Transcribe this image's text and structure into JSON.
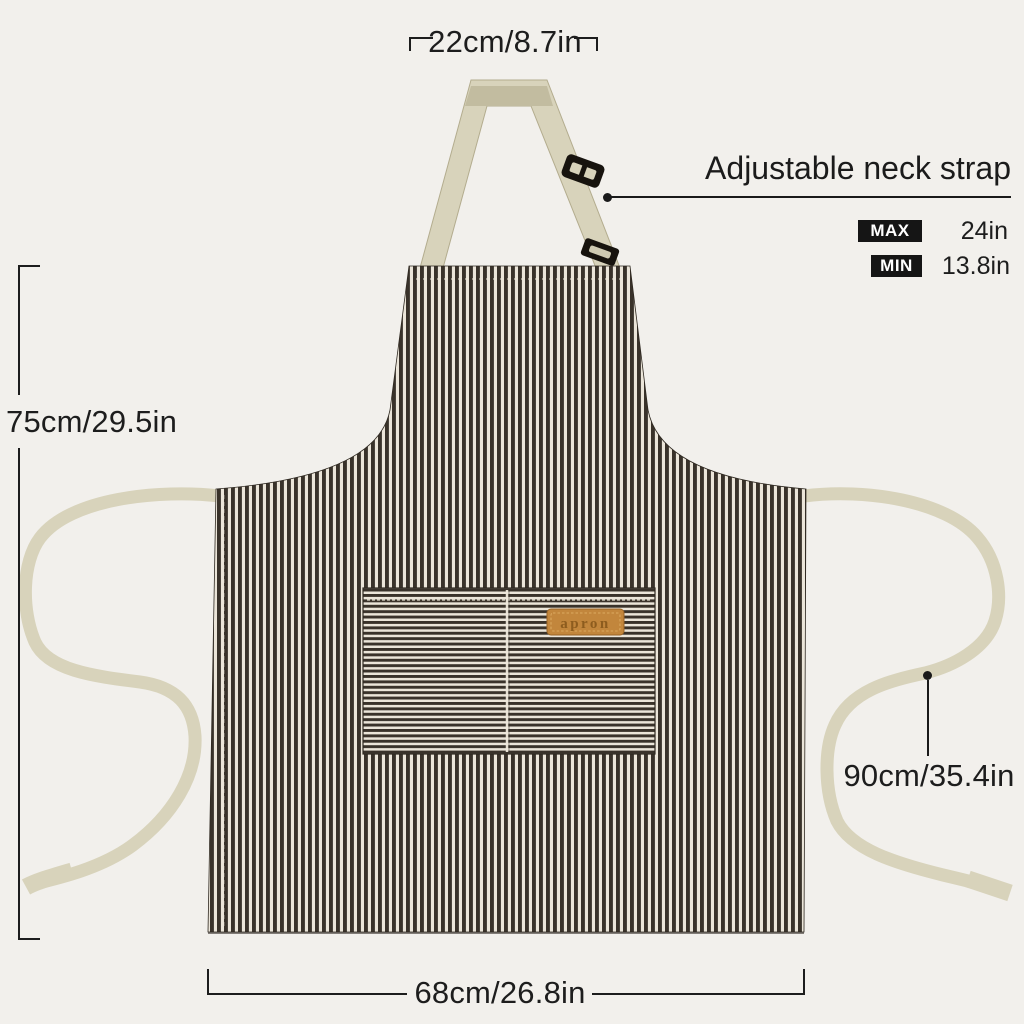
{
  "apron": {
    "label_text": "apron",
    "colors": {
      "background": "#f2f0ec",
      "stripe_dark": "#39322a",
      "stripe_light": "#ebe5d9",
      "strap": "#d8d3bb",
      "strap_fold": "#c2bca0",
      "buckle": "#17130e",
      "label_leather": "#c2863c",
      "label_text": "#8d5c1e",
      "annotation_text": "#1d1d1d",
      "badge_background": "#151515"
    }
  },
  "annotations": {
    "top_width": "22cm/8.7in",
    "left_height": "75cm/29.5in",
    "tie_length": "90cm/35.4in",
    "bottom_width": "68cm/26.8in",
    "neck_strap": {
      "label": "Adjustable neck strap",
      "max_label": "MAX",
      "max_value": "24in",
      "min_label": "MIN",
      "min_value": "13.8in"
    }
  }
}
